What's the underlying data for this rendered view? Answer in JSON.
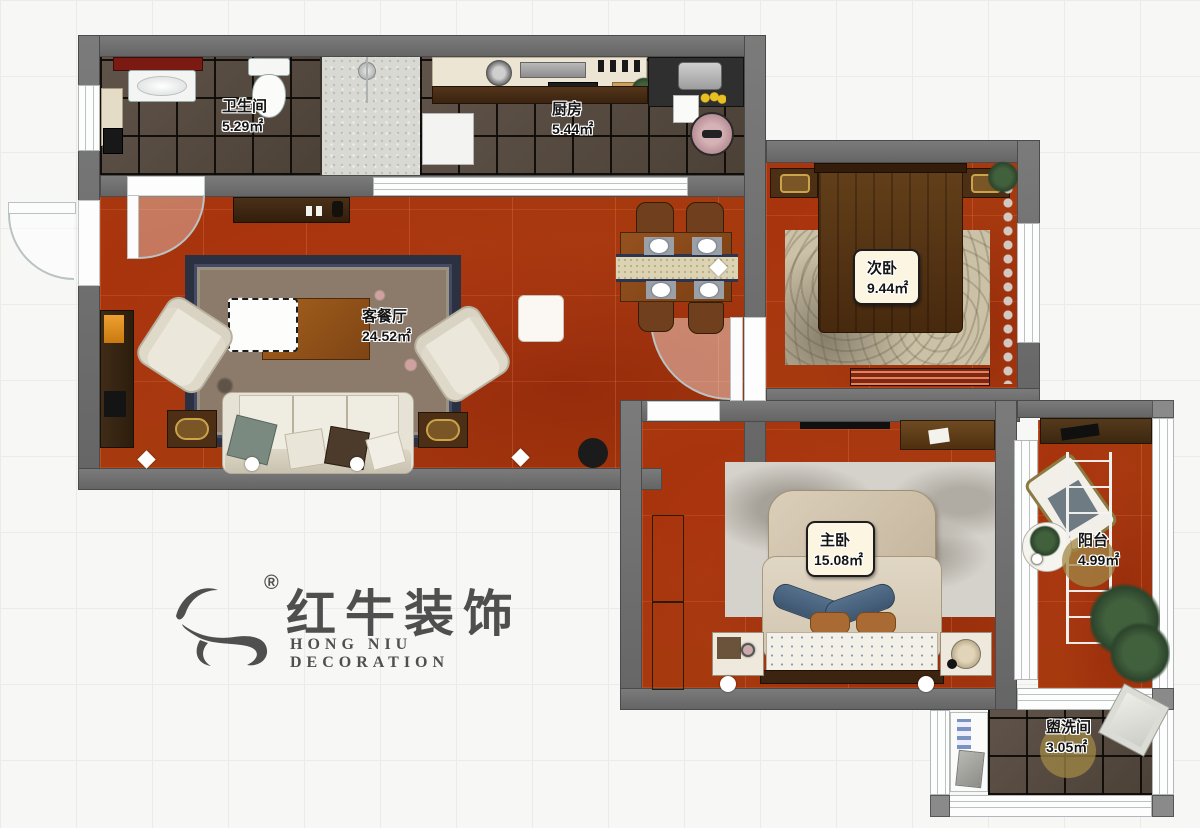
{
  "colors": {
    "background": "#f7f7f6",
    "grid_line": "#ebebe7",
    "wall": "#707070",
    "wall_edge": "#4b4b4b",
    "floor_red": "#a7390f",
    "floor_tile_dark": "#564a3e",
    "tile_grout": "#141210",
    "shower_tile": "#d9d9d4",
    "label_box_bg": "#fcf5e1",
    "logo_gray": "#4f4f4f"
  },
  "rooms": [
    {
      "name": "bathroom",
      "label": "卫生间",
      "area": "5.29㎡"
    },
    {
      "name": "kitchen",
      "label": "厨房",
      "area": "5.44㎡"
    },
    {
      "name": "living-dining",
      "label": "客餐厅",
      "area": "24.52㎡"
    },
    {
      "name": "bedroom-second",
      "label": "次卧",
      "area": "9.44㎡"
    },
    {
      "name": "bedroom-master",
      "label": "主卧",
      "area": "15.08㎡"
    },
    {
      "name": "balcony",
      "label": "阳台",
      "area": "4.99㎡"
    },
    {
      "name": "washroom",
      "label": "盥洗间",
      "area": "3.05㎡"
    }
  ],
  "logo": {
    "icon": "bull-icon",
    "registered_mark": "®",
    "brand_cn": "红牛装饰",
    "brand_en": "HONG NIU DECORATION"
  }
}
